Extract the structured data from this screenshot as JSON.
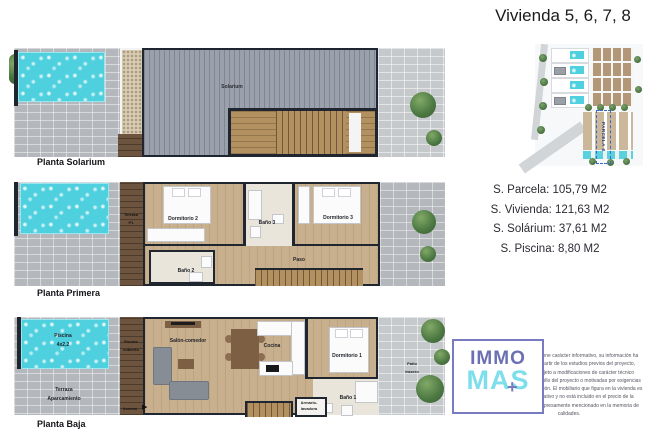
{
  "title": "Vivienda 5, 6, 7, 8",
  "measurements": [
    {
      "text": "S. Parcela: 105,79 M2"
    },
    {
      "text": "S. Vivienda: 121,63 M2"
    },
    {
      "text": "S. Solárium: 37,61 M2"
    },
    {
      "text": "S. Piscina: 8,80 M2"
    }
  ],
  "plans": {
    "solarium": {
      "name": "Planta Solarium",
      "rooms": {
        "solarium": "Solarium"
      }
    },
    "primera": {
      "name": "Planta Primera",
      "rooms": {
        "terraza1": "Terraza",
        "terraza2": "P1",
        "dormitorio2": "Dormitorio 2",
        "bano3": "Baño 3",
        "dormitorio3": "Dormitorio 3",
        "bano2": "Baño 2",
        "paso": "Paso"
      }
    },
    "baja": {
      "name": "Planta Baja",
      "rooms": {
        "piscina1": "Piscina",
        "piscina2": "4x2,2",
        "terraza1": "Terraza",
        "terraza2": "Aparcamiento",
        "porche1": "Porche",
        "porche2": "cubierto",
        "acceso": "Acceso",
        "salon": "Salón-comedor",
        "cocina": "Cocina",
        "dormitorio1": "Dormitorio 1",
        "bano1": "Baño 1",
        "armario1": "Armario-",
        "armario2": "lavadora",
        "patio1": "Patio",
        "patio2": "trasero"
      }
    }
  },
  "siteplan": {
    "parcel_label": "PARCELA 8"
  },
  "logo": {
    "immo": "IMMO",
    "mas": "MAS",
    "plus": "+"
  },
  "disclaimer": "El presente plano tiene carácter informativo, su información ha sido elaborada a partir de los estudios previos del proyecto, pudiendo estar sujeto a modificaciones de carácter técnico derivadas del desarrollo del proyecto o motivadas por exigencias técnicas de su ejecución. El mobiliario que figura en la vivienda es meramente decorativo y no está incluido en el precio de la vivienda, salvo lo expresamente mencionado en la memoria de calidades.",
  "colors": {
    "pool": "#4ed0de",
    "wall": "#20262f",
    "logo_purple": "#6b70b4",
    "logo_cyan": "#7edeeb"
  }
}
